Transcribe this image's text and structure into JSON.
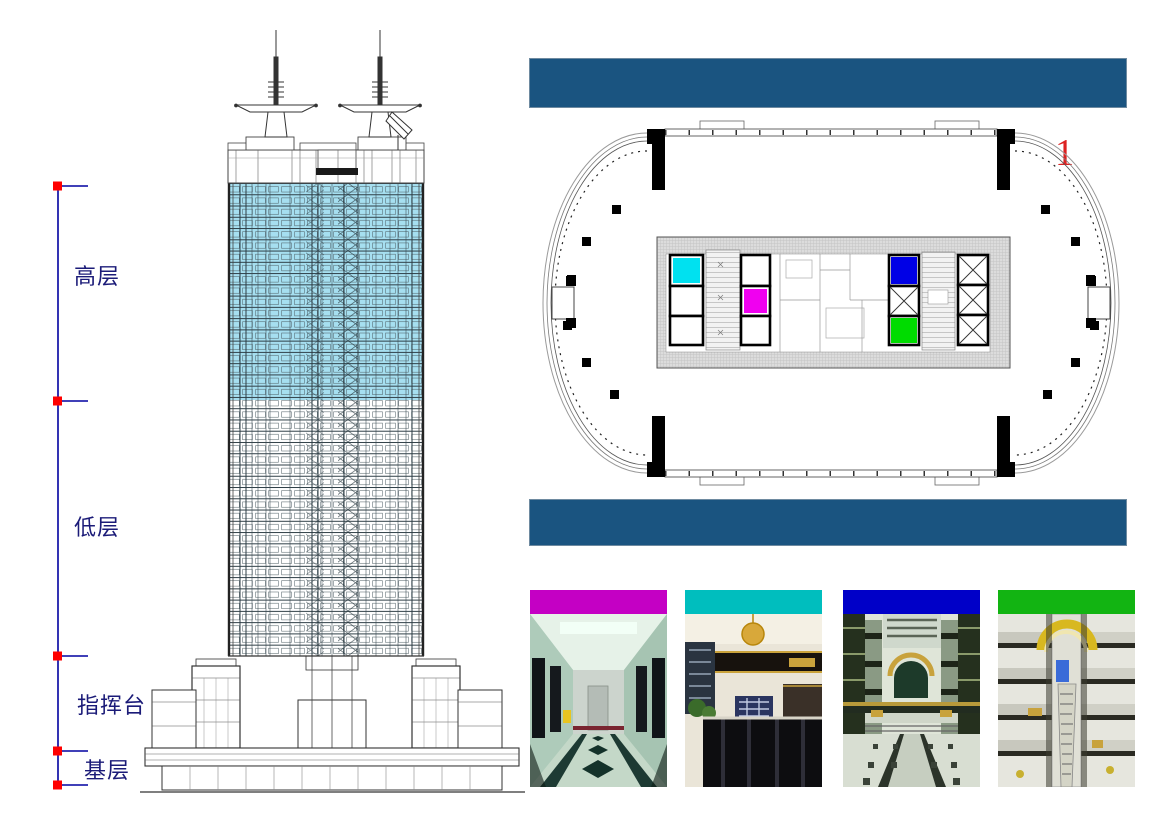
{
  "slide": {
    "number": "1",
    "number_color": "#dd2222",
    "background": "#ffffff"
  },
  "header_bars": {
    "color": "#1a5480"
  },
  "left_scale": {
    "line_color": "#0000a0",
    "marker_color": "#ff0000",
    "text_color": "#1b1b78",
    "labels": [
      {
        "id": "high-floors",
        "text": "高层"
      },
      {
        "id": "low-floors",
        "text": "低层"
      },
      {
        "id": "command-platform",
        "text": "指挥台"
      },
      {
        "id": "base-level",
        "text": "基层"
      }
    ]
  },
  "elevation": {
    "highlight_color": "#a6dff0",
    "line_color": "#37474f"
  },
  "floor_plan": {
    "highlight_squares": [
      {
        "name": "cyan-zone",
        "color": "#00e1f0"
      },
      {
        "name": "magenta-zone",
        "color": "#f000f0"
      },
      {
        "name": "blue-zone",
        "color": "#0000e6"
      },
      {
        "name": "green-zone",
        "color": "#00dc00"
      }
    ]
  },
  "photos": [
    {
      "name": "corridor-photo",
      "header_color": "#c400c4"
    },
    {
      "name": "lobby-photo",
      "header_color": "#00bebe"
    },
    {
      "name": "atrium-photo",
      "header_color": "#0000c8"
    },
    {
      "name": "escalator-photo",
      "header_color": "#12b412"
    }
  ]
}
